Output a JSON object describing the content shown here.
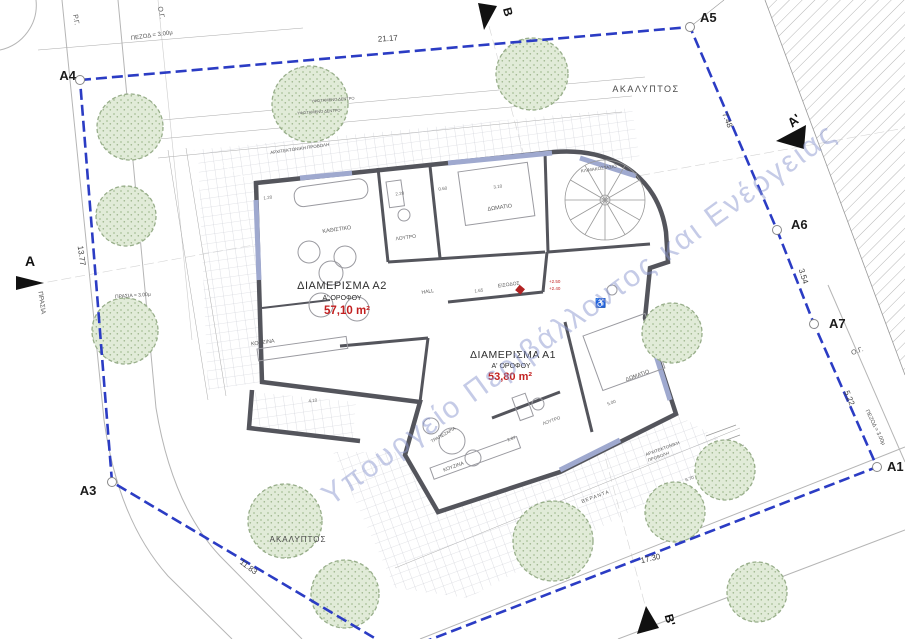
{
  "document": {
    "type": "architectural first-floor plan / site plan",
    "language": "Greek"
  },
  "watermark": {
    "text": "Υπουργείο Περιβάλλοντος και Ενέργειας",
    "color": "#8b98d0"
  },
  "colors": {
    "boundary_blue": "#2b3cc4",
    "wall_gray": "#54555c",
    "window_accent_blue": "#9fa9cf",
    "tree_green_fill": "#e1ebd8",
    "tree_green_stroke": "#98ae8a",
    "area_value_red": "#c22020",
    "dimension_gray": "#444444"
  },
  "apartments": [
    {
      "id": "A2",
      "title": "ΔΙΑΜΕΡΙΣΜΑ Α2",
      "floor": "Α' ΟΡΟΦΟΥ",
      "area": "57,10 m²"
    },
    {
      "id": "A1",
      "title": "ΔΙΑΜΕΡΙΣΜΑ Α1",
      "floor": "Α' ΟΡΟΦΟΥ",
      "area": "53,80 m²"
    }
  ],
  "boundary": {
    "corner_labels": [
      "A4",
      "A5",
      "A6",
      "A7",
      "A1",
      "A3"
    ],
    "edge_dimensions": [
      "21.17",
      "7.48",
      "3.54",
      "5.22",
      "17.30",
      "11.83",
      "13.77"
    ]
  },
  "section_markers": [
    "A",
    "A'",
    "B",
    "B'"
  ],
  "labels": [
    {
      "name": "corner-label-a4",
      "text": "A4",
      "x": 76,
      "y": 80,
      "s": 13,
      "a": "end",
      "w": 600,
      "c": "#1c1c1c"
    },
    {
      "name": "corner-label-a5",
      "text": "A5",
      "x": 700,
      "y": 22,
      "s": 13,
      "a": "start",
      "w": 600,
      "c": "#1c1c1c"
    },
    {
      "name": "corner-label-a6",
      "text": "A6",
      "x": 791,
      "y": 229,
      "s": 13,
      "a": "start",
      "w": 600,
      "c": "#1c1c1c"
    },
    {
      "name": "corner-label-a7",
      "text": "A7",
      "x": 829,
      "y": 328,
      "s": 13,
      "a": "start",
      "w": 600,
      "c": "#1c1c1c"
    },
    {
      "name": "corner-label-a1",
      "text": "A1",
      "x": 887,
      "y": 471,
      "s": 13,
      "a": "start",
      "w": 600,
      "c": "#1c1c1c"
    },
    {
      "name": "corner-label-a3",
      "text": "A3",
      "x": 88,
      "y": 495,
      "s": 13,
      "a": "middle",
      "w": 600,
      "c": "#1c1c1c"
    },
    {
      "name": "section-label-a",
      "text": "A",
      "x": 30,
      "y": 266,
      "s": 14,
      "a": "middle",
      "w": 600,
      "c": "#111111"
    },
    {
      "name": "section-label-a-prime",
      "text": "A'",
      "x": 797,
      "y": 124,
      "s": 13,
      "a": "middle",
      "w": 600,
      "c": "#111111",
      "r": -40
    },
    {
      "name": "section-label-b",
      "text": "B",
      "x": 504,
      "y": 13,
      "s": 12,
      "a": "middle",
      "w": 600,
      "c": "#111111",
      "r": 75
    },
    {
      "name": "section-label-b-prime",
      "text": "B'",
      "x": 666,
      "y": 621,
      "s": 12,
      "a": "middle",
      "w": 600,
      "c": "#111111",
      "r": 75
    },
    {
      "name": "boundary-dim-top",
      "text": "21.17",
      "x": 388,
      "y": 41,
      "s": 8,
      "r": -4,
      "c": "#444444"
    },
    {
      "name": "boundary-dim-a5-a6",
      "text": "7.48",
      "x": 725,
      "y": 121,
      "s": 8,
      "r": 68,
      "c": "#444444"
    },
    {
      "name": "boundary-dim-a6-a7",
      "text": "3.54",
      "x": 801,
      "y": 277,
      "s": 8,
      "r": 72,
      "c": "#444444"
    },
    {
      "name": "boundary-dim-a7-a1",
      "text": "5.22",
      "x": 847,
      "y": 399,
      "s": 8,
      "r": 67,
      "c": "#444444"
    },
    {
      "name": "boundary-dim-bottom-right",
      "text": "17.30",
      "x": 651,
      "y": 561,
      "s": 8,
      "r": -13,
      "c": "#444444"
    },
    {
      "name": "boundary-dim-bottom-left",
      "text": "11.83",
      "x": 247,
      "y": 569,
      "s": 8,
      "r": 37,
      "c": "#444444"
    },
    {
      "name": "boundary-dim-left",
      "text": "13.77",
      "x": 79,
      "y": 256,
      "s": 8,
      "r": 82,
      "c": "#444444"
    },
    {
      "name": "sidewalk-dim-top",
      "text": "ΠΕΖΟΔ = 3.00μ",
      "x": 152,
      "y": 37,
      "s": 6,
      "r": -8,
      "c": "#555555"
    },
    {
      "name": "street-line-label-top",
      "text": "Ρ.Γ.",
      "x": 74,
      "y": 20,
      "s": 7,
      "r": 80,
      "c": "#555555"
    },
    {
      "name": "building-line-label-top",
      "text": "Ο.Γ.",
      "x": 159,
      "y": 13,
      "s": 7,
      "r": 80,
      "c": "#555555"
    },
    {
      "name": "building-line-label-right",
      "text": "Ο.Γ.",
      "x": 858,
      "y": 353,
      "s": 7,
      "r": -20,
      "c": "#555555"
    },
    {
      "name": "sidewalk-dim-right",
      "text": "ΠΕΖΟΔ = 3.00μ",
      "x": 874,
      "y": 428,
      "s": 5.5,
      "r": 64,
      "c": "#555555"
    },
    {
      "name": "green-strip-label-left",
      "text": "ΠΡΑΣΙΑ",
      "x": 40,
      "y": 303,
      "s": 6.5,
      "r": 82,
      "c": "#555555"
    },
    {
      "name": "green-strip-dim",
      "text": "ΠΡΑΣΙΑ = 3.00μ",
      "x": 133,
      "y": 297,
      "s": 5,
      "r": -4,
      "c": "#555555"
    },
    {
      "name": "area-label-akalyptos-top",
      "text": "ΑΚΑΛΥΠΤΟΣ",
      "x": 646,
      "y": 92,
      "s": 9,
      "c": "#4a4a4a",
      "ls": 1.5
    },
    {
      "name": "area-label-akalyptos-bottom",
      "text": "ΑΚΑΛΥΠΤΟΣ",
      "x": 298,
      "y": 542,
      "s": 8,
      "c": "#4a4a4a",
      "ls": 1
    },
    {
      "name": "apartment-a2-title",
      "text": "ΔΙΑΜΕΡΙΣΜΑ Α2",
      "x": 342,
      "y": 289,
      "s": 11,
      "c": "#2e2e2e",
      "ls": 0.5
    },
    {
      "name": "apartment-a2-floor",
      "text": "Α' ΟΡΟΦΟΥ",
      "x": 342,
      "y": 300,
      "s": 7,
      "c": "#2e2e2e"
    },
    {
      "name": "apartment-a2-area",
      "text": "57,10 m²",
      "x": 347,
      "y": 314,
      "s": 11.5,
      "c": "#c22020",
      "w": 700
    },
    {
      "name": "apartment-a1-title",
      "text": "ΔΙΑΜΕΡΙΣΜΑ Α1",
      "x": 513,
      "y": 358,
      "s": 10.5,
      "c": "#2e2e2e",
      "ls": 0.5
    },
    {
      "name": "apartment-a1-floor",
      "text": "Α' ΟΡΟΦΟΥ",
      "x": 511,
      "y": 368,
      "s": 7,
      "c": "#2e2e2e"
    },
    {
      "name": "apartment-a1-area",
      "text": "53,80 m²",
      "x": 510,
      "y": 380,
      "s": 11,
      "c": "#c22020",
      "w": 700
    },
    {
      "name": "room-label-living-a2",
      "text": "ΚΑΘΙΣΤΙΚΟ",
      "x": 337,
      "y": 231,
      "s": 5.5,
      "r": -8,
      "c": "#5a5a5a"
    },
    {
      "name": "room-label-bath-a2",
      "text": "ΛΟΥΤΡΟ",
      "x": 406,
      "y": 239,
      "s": 5,
      "r": -8,
      "c": "#5a5a5a"
    },
    {
      "name": "room-label-bedroom-top",
      "text": "ΔΩΜΑΤΙΟ",
      "x": 500,
      "y": 209,
      "s": 5.5,
      "r": -8,
      "c": "#5a5a5a"
    },
    {
      "name": "room-label-staircase",
      "text": "ΚΛΙΜΑΚΟΣΤΑΣΙΟ",
      "x": 599,
      "y": 170,
      "s": 4.5,
      "r": -8,
      "c": "#5a5a5a"
    },
    {
      "name": "room-label-kitchen-a2",
      "text": "ΚΟΥΖΙΝΑ",
      "x": 263,
      "y": 344,
      "s": 5.5,
      "r": -8,
      "c": "#5a5a5a"
    },
    {
      "name": "room-label-hall",
      "text": "HALL",
      "x": 428,
      "y": 293,
      "s": 5,
      "r": -8,
      "c": "#5a5a5a"
    },
    {
      "name": "room-label-entrance",
      "text": "ΕΙΣΟΔΟΣ",
      "x": 509,
      "y": 286,
      "s": 5,
      "r": -8,
      "c": "#5a5a5a"
    },
    {
      "name": "level-value-upper",
      "text": "+2.50",
      "x": 549,
      "y": 283,
      "s": 4.5,
      "c": "#c22020",
      "a": "start"
    },
    {
      "name": "level-value-lower",
      "text": "+2.40",
      "x": 549,
      "y": 290,
      "s": 4.5,
      "c": "#c22020",
      "a": "start"
    },
    {
      "name": "room-label-bedroom-a1",
      "text": "ΔΩΜΑΤΙΟ",
      "x": 638,
      "y": 377,
      "s": 5.5,
      "r": -20,
      "c": "#5a5a5a"
    },
    {
      "name": "room-label-bath-a1",
      "text": "ΛΟΥΤΡΟ",
      "x": 552,
      "y": 422,
      "s": 4.5,
      "r": -20,
      "c": "#5a5a5a"
    },
    {
      "name": "room-label-kitchen-a1",
      "text": "ΚΟΥΖΙΝΑ",
      "x": 454,
      "y": 468,
      "s": 5,
      "r": -20,
      "c": "#5a5a5a"
    },
    {
      "name": "room-label-dining-a1",
      "text": "ΤΡΑΠΕΖΑΡΙΑ",
      "x": 444,
      "y": 436,
      "s": 4.5,
      "r": -30,
      "c": "#5a5a5a"
    },
    {
      "name": "veranda-label",
      "text": "ΒΕΡΑΝΤΑ",
      "x": 596,
      "y": 498,
      "s": 5,
      "r": -20,
      "c": "#5a5a5a",
      "ls": 1
    },
    {
      "name": "arch-projection-label-line1",
      "text": "ΑΡΧΙΤΕΚΤΟΝΙΚΗ",
      "x": 663,
      "y": 450,
      "s": 4.5,
      "r": -20,
      "c": "#5a5a5a"
    },
    {
      "name": "arch-projection-label-line2",
      "text": "ΠΡΟΒΟΛΗ",
      "x": 659,
      "y": 458,
      "s": 4.5,
      "r": -20,
      "c": "#5a5a5a"
    },
    {
      "name": "terrace-label",
      "text": "ΑΡΧΙΤΕΚΤΟΝΙΚΗ ΠΡΟΒΟΛΗ",
      "x": 300,
      "y": 150,
      "s": 4.5,
      "r": -8,
      "c": "#5a5a5a"
    },
    {
      "name": "tree-note-line1",
      "text": "ΥΦΙΣΤΑΜΕΝΟ ΔΕΝΤΡΟ",
      "x": 333,
      "y": 101,
      "s": 4,
      "r": -4,
      "c": "#5a5a5a"
    },
    {
      "name": "tree-note-line2",
      "text": "ΥΦΙΣΤΑΜΕΝΟ ΔΕΝΤΡΟ",
      "x": 319,
      "y": 113,
      "s": 4,
      "r": -4,
      "c": "#5a5a5a"
    },
    {
      "name": "accessibility-icon",
      "text": "♿",
      "x": 601,
      "y": 306,
      "s": 9,
      "c": "#555555"
    },
    {
      "name": "interior-dim-1",
      "text": "3.10",
      "x": 498,
      "y": 188,
      "s": 4.5,
      "r": -8,
      "c": "#666666"
    },
    {
      "name": "interior-dim-2",
      "text": "2.20",
      "x": 400,
      "y": 195,
      "s": 4.5,
      "r": -8,
      "c": "#666666"
    },
    {
      "name": "interior-dim-3",
      "text": "0.60",
      "x": 443,
      "y": 190,
      "s": 4.5,
      "r": -8,
      "c": "#666666"
    },
    {
      "name": "interior-dim-4",
      "text": "1.20",
      "x": 268,
      "y": 199,
      "s": 4.5,
      "r": -8,
      "c": "#666666"
    },
    {
      "name": "interior-dim-5",
      "text": "4.10",
      "x": 313,
      "y": 402,
      "s": 4.5,
      "r": -8,
      "c": "#666666"
    },
    {
      "name": "interior-dim-6",
      "text": "1.65",
      "x": 479,
      "y": 292,
      "s": 4.5,
      "r": -8,
      "c": "#666666"
    },
    {
      "name": "interior-dim-7",
      "text": "5.00",
      "x": 612,
      "y": 404,
      "s": 4.5,
      "r": -20,
      "c": "#666666"
    },
    {
      "name": "interior-dim-8",
      "text": "2.87",
      "x": 512,
      "y": 440,
      "s": 4.5,
      "r": -20,
      "c": "#666666"
    },
    {
      "name": "interior-dim-9",
      "text": "6.70",
      "x": 690,
      "y": 480,
      "s": 4.5,
      "r": -20,
      "c": "#666666"
    }
  ]
}
